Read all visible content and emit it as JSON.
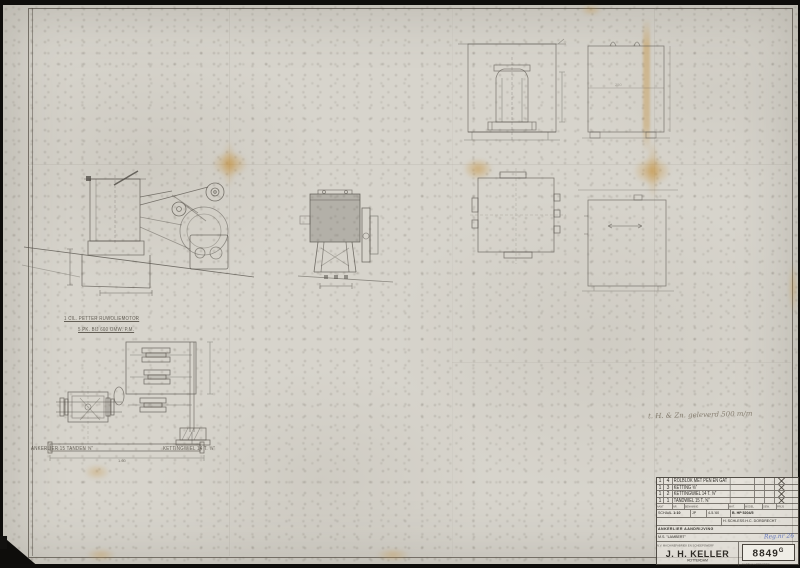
{
  "annotations": {
    "motor_caption_1": "1 CIL. PETTER RUWOLIEMOTOR",
    "motor_caption_2": "5 PK. BIJ 600 OMW. P.M.",
    "plan_caption_left": "ANKERLIER 15 TANDEN ⅝″",
    "plan_caption_right": "KETTINGWIEL 14 T. ⅝″",
    "plan_dim": "1.60",
    "side_dim": "250",
    "pencil_note": "t. H. & Zn. geleverd 500 m/m"
  },
  "stamp": {
    "parts": {
      "rows": [
        {
          "qty": "1",
          "nr": "4",
          "desc": "ROLBLOK MET PEN EN GAT"
        },
        {
          "qty": "1",
          "nr": "3",
          "desc": "KETTING ⅝″"
        },
        {
          "qty": "1",
          "nr": "2",
          "desc": "KETTINGWIEL 14 T. ⅝″"
        },
        {
          "qty": "1",
          "nr": "1",
          "desc": "TANDWIEL 15 T. ⅝″"
        }
      ],
      "headers": [
        "AANT",
        "NR",
        "BENAMING",
        "MAT.",
        "MODEL",
        "GEW.",
        "PRIJS"
      ]
    },
    "scale_label": "SCHAAL",
    "scale": "1:10",
    "drawn_label": "GET.",
    "drawn": "JP",
    "date": "4-5-'60",
    "order_no": "B. HP 5204/5",
    "client": "H. SCHLESS H.C. DORDRECHT",
    "subject": "ANKERLIER AANDRIJVING",
    "ship": "M.S. \"LAMBERT\"",
    "reg_note": "Reg.nr 26",
    "company_line": "N.V. MACHINEFABRIEK EN SCHEEPSWERF",
    "company": "J. H. KELLER",
    "city": "ROTTERDAM",
    "drawing_no": "8849",
    "drawing_no_suffix": "G",
    "fineprint": "NADRUK VERBODEN"
  }
}
